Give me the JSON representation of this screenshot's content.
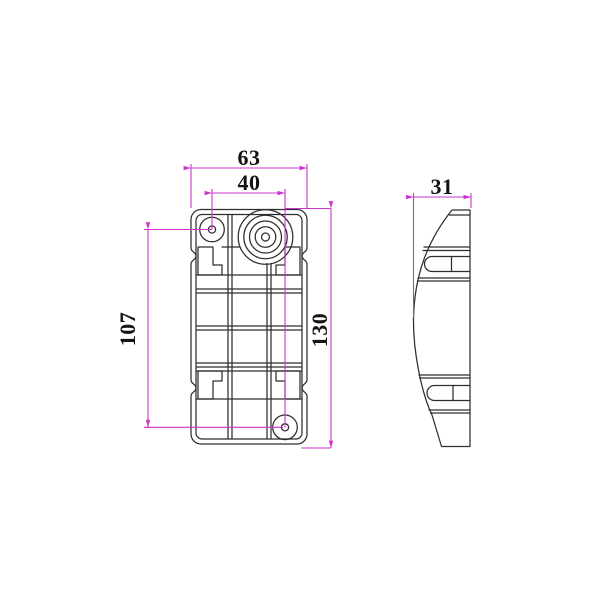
{
  "drawing": {
    "dimensions": {
      "front_width": "63",
      "hole_spacing_x": "40",
      "hole_spacing_y": "107",
      "front_height": "130",
      "side_depth": "31"
    },
    "colors": {
      "dimension_line": "#cc33cc",
      "drawing_line": "#2e2e2e",
      "background": "#ffffff"
    }
  }
}
